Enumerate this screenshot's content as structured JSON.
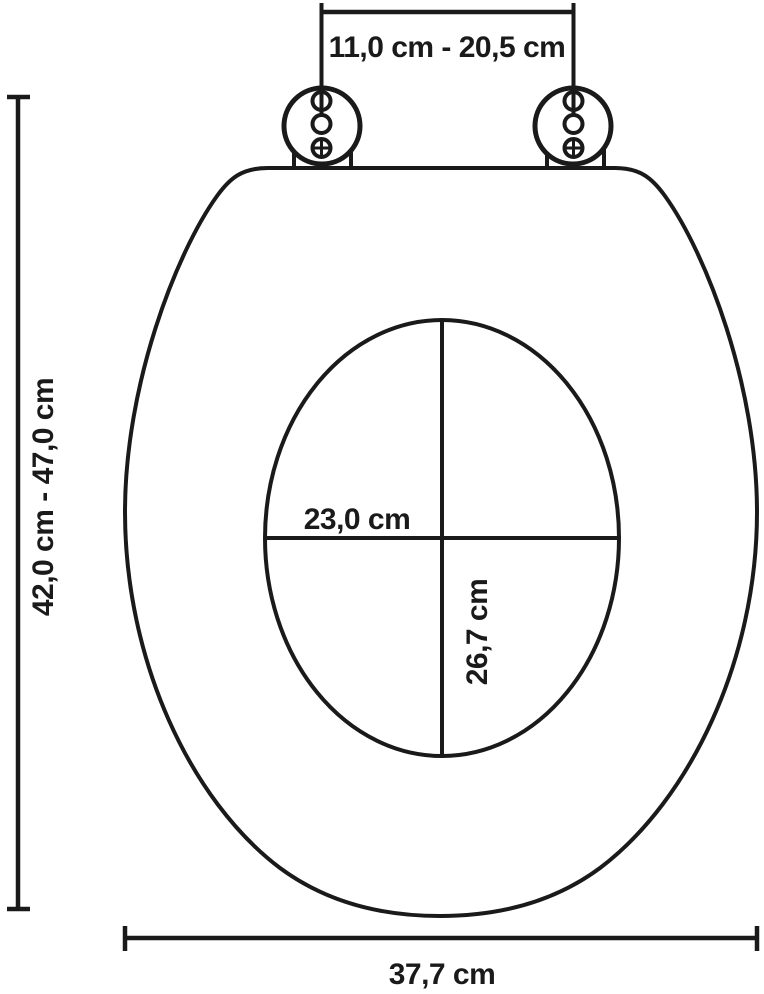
{
  "diagram": {
    "title": "toilet-seat-dimension-diagram",
    "background_color": "#ffffff",
    "line_color": "#1a1a1a",
    "labels": {
      "hinge_distance": "11,0 cm - 20,5 cm",
      "total_length": "42,0 cm - 47,0 cm",
      "inner_width": "23,0 cm",
      "inner_depth": "26,7 cm",
      "total_width": "37,7 cm"
    },
    "measurements": [
      {
        "dimension": "hinge fixing hole distance (adjustable)",
        "value": "11,0 cm - 20,5 cm"
      },
      {
        "dimension": "total seat length (adjustable)",
        "value": "42,0 cm - 47,0 cm"
      },
      {
        "dimension": "inner opening width",
        "value": "23,0 cm"
      },
      {
        "dimension": "inner opening depth",
        "value": "26,7 cm"
      },
      {
        "dimension": "total seat width",
        "value": "37,7 cm"
      }
    ]
  }
}
